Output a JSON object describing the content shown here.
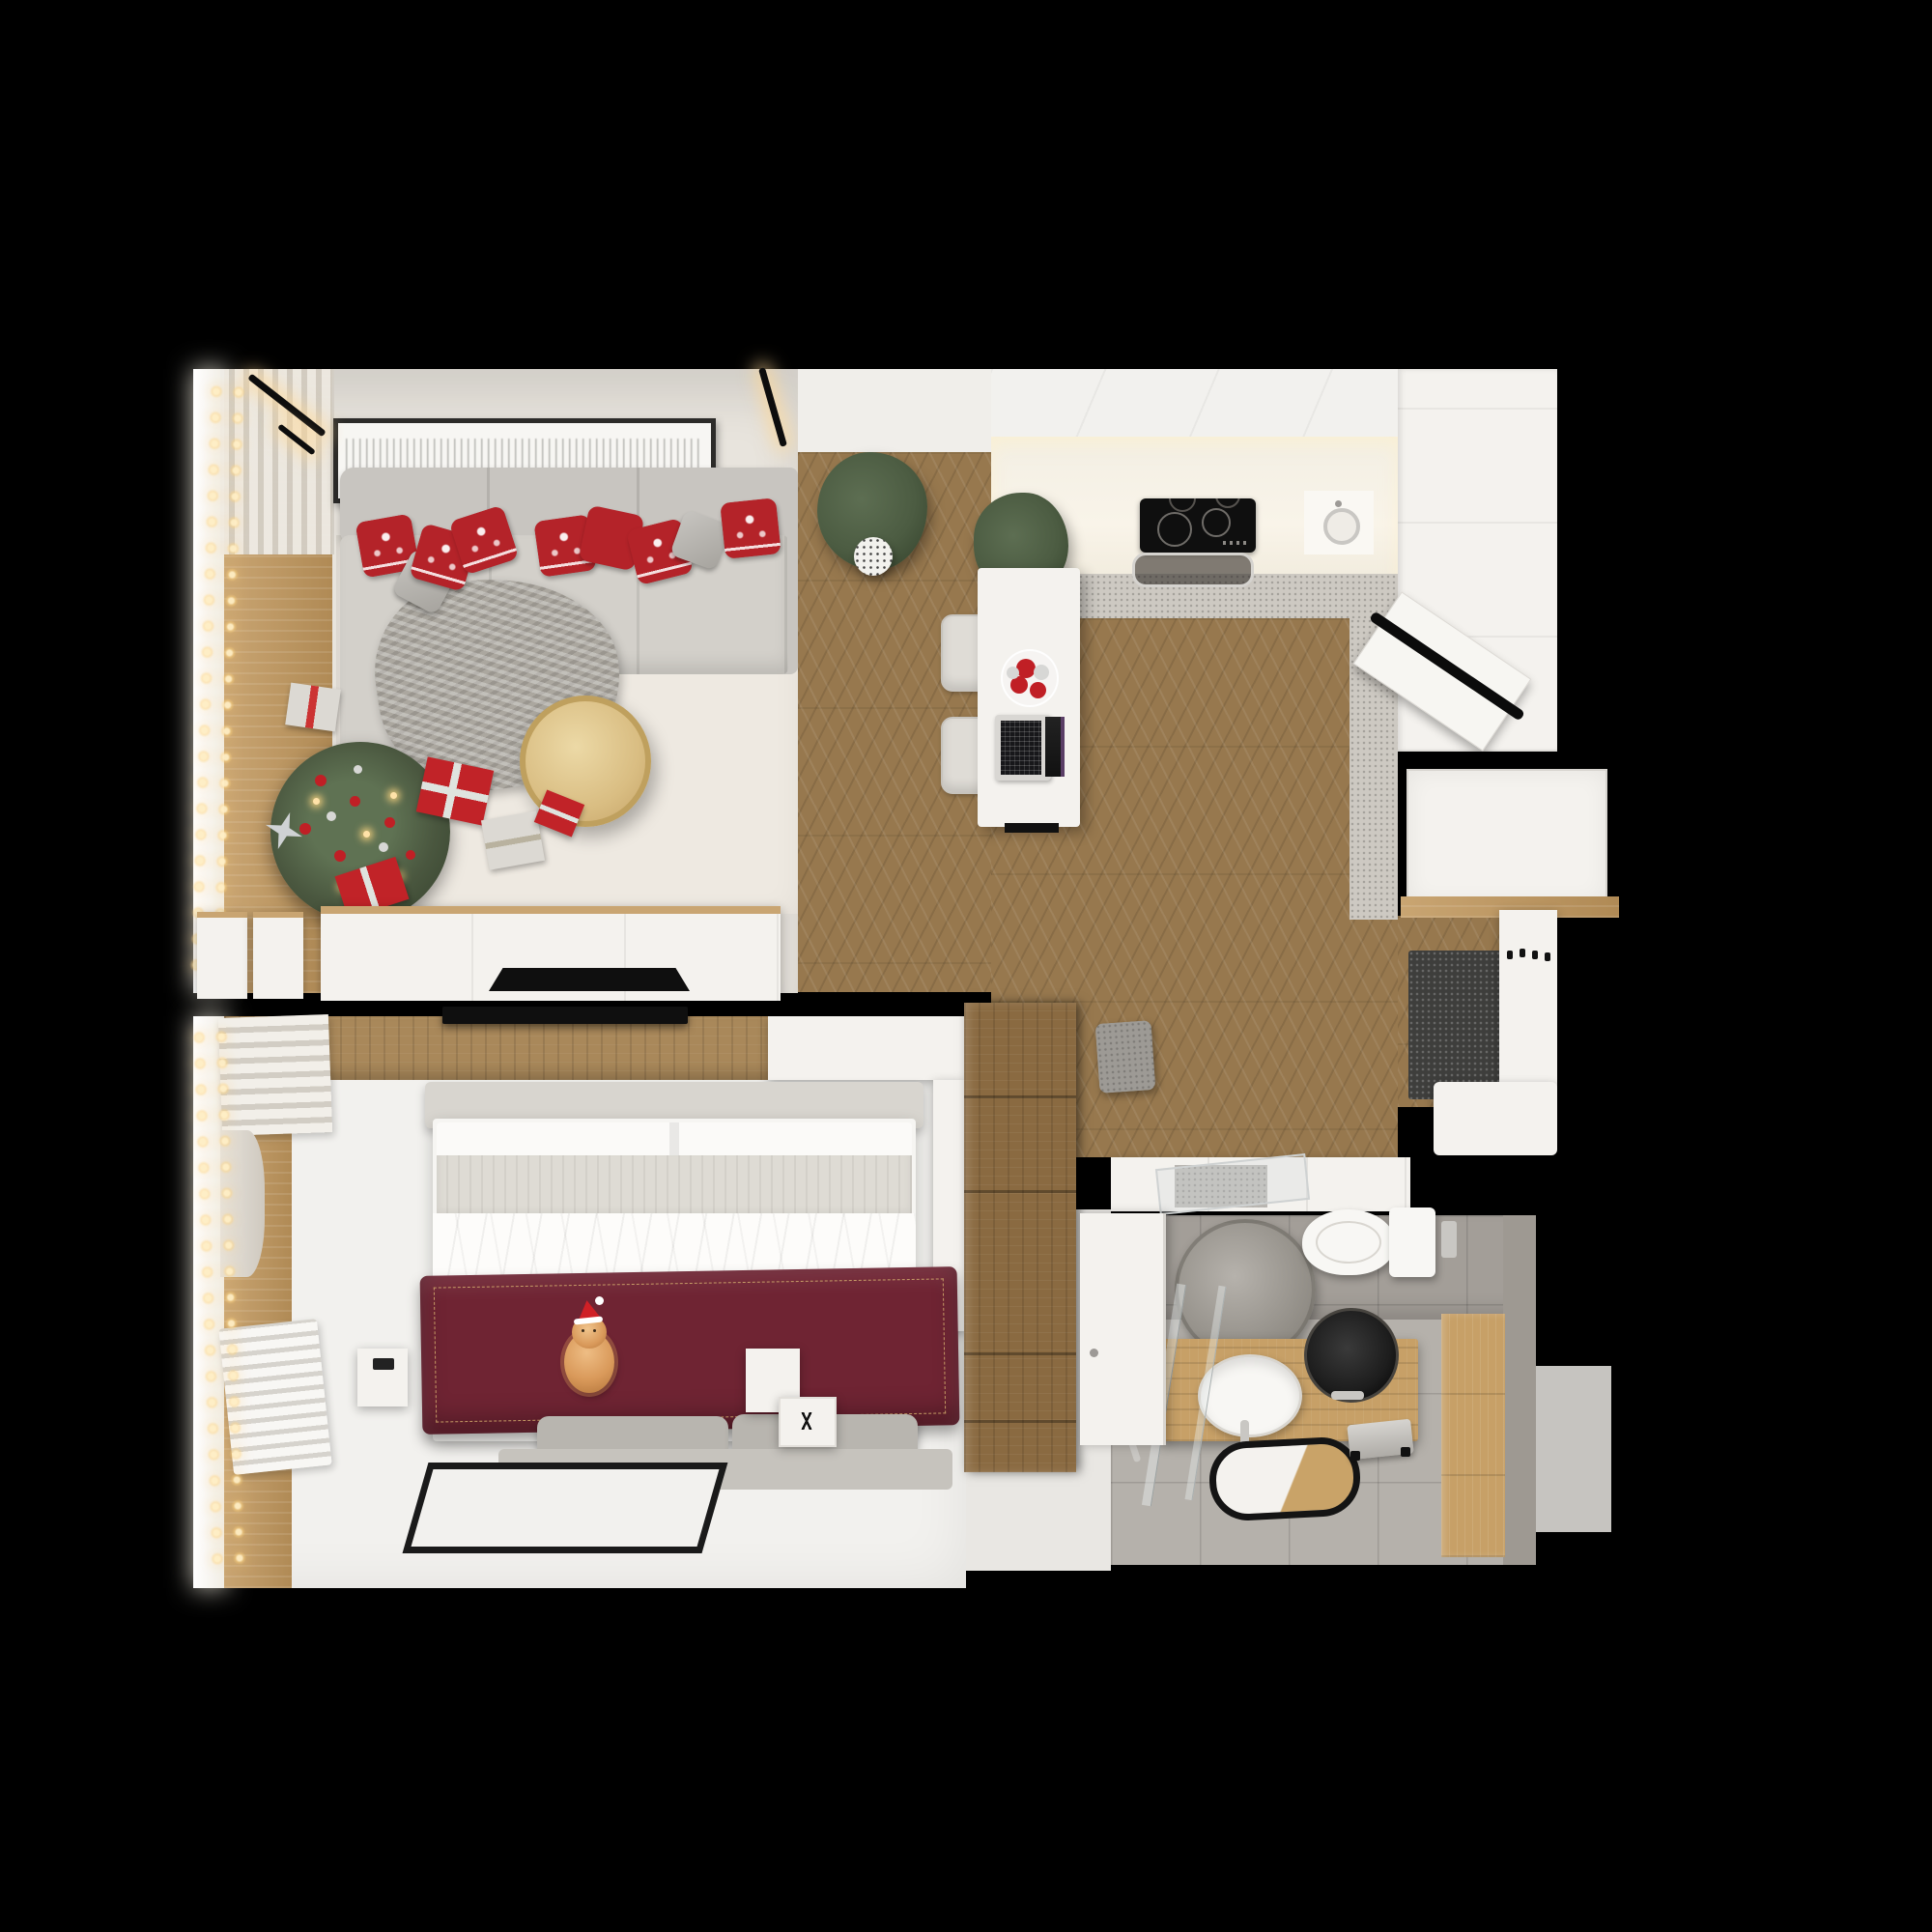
{
  "scene": {
    "title": "apartment-floor-plan-3d-render",
    "description": "Top-down photorealistic 3D render of a small one-bedroom apartment decorated for Christmas, on a black background",
    "rooms": [
      {
        "name": "living-room",
        "objects": [
          "corner-sofa",
          "nordic-red-pillows",
          "grey-pillows",
          "knit-throw",
          "gold-round-coffee-table",
          "christmas-tree-with-ornaments",
          "gift-boxes",
          "string-lights-garland",
          "framed-wall-art",
          "linear-wall-sconces",
          "tv-sideboard",
          "flat-tv",
          "window-with-curtains",
          "area-rug",
          "window-side-cabinets"
        ]
      },
      {
        "name": "kitchen-dining",
        "objects": [
          "chevron-parquet-floor",
          "white-cabinet-run",
          "tall-white-units",
          "induction-cooktop",
          "extractor-tray",
          "round-steel-sink",
          "speckled-countertop",
          "breakfast-bar",
          "two-bar-stools",
          "open-laptop",
          "plate-of-baubles",
          "two-potted-plants",
          "open-white-door-with-black-handle",
          "ceiling-spot"
        ]
      },
      {
        "name": "hallway-entry",
        "objects": [
          "open-entry-door",
          "wood-threshold",
          "dark-doormat",
          "coat-hook-panel",
          "shoe-bench",
          "tall-wooden-wardrobe",
          "grey-pouf",
          "closet-band-with-mirror-door"
        ]
      },
      {
        "name": "bedroom",
        "objects": [
          "double-bed",
          "burgundy-quilt-gold-stitch",
          "ginger-cat-in-santa-hat",
          "headboard-bench",
          "white-duvet",
          "grey-foot-cushions",
          "foot-mat",
          "black-frame-rug",
          "bedside-tables",
          "wall-mounted-tv",
          "wood-accent-band",
          "roman-shade",
          "curtain-drape",
          "radiator",
          "string-lights-garland",
          "white-console"
        ]
      },
      {
        "name": "bathroom",
        "objects": [
          "round-stone-mirror",
          "wall-hung-toilet",
          "flush-plate",
          "wooden-vanity",
          "black-vessel-sink",
          "white-oval-basin",
          "chrome-faucets",
          "shower-glass-panels",
          "shower-head",
          "black-rim-bath-mat",
          "step-stool",
          "wood-wall-panel",
          "open-white-door",
          "grey-exterior-block"
        ]
      }
    ]
  },
  "palette": {
    "bg": "#000000",
    "lr_floor": "#e8e4dd",
    "lr_rug": "#eee9e1",
    "wood_floor": "#97784e",
    "wood_light": "#c9a572",
    "wood_accent": "#a9885a",
    "wood_wardrobe": "#8a6a41",
    "white_furn": "#f4f2ee",
    "kitchen_white": "#f2f1ee",
    "kitchen_warm": "#f9f4e9",
    "counter_speckle": "#cdc9c2",
    "sofa": "#c8c5c0",
    "sofa_seat": "#d3d0ca",
    "pillow_red": "#b42329",
    "pillow_grey": "#b4b1ab",
    "throw_grey": "#aba79f",
    "table_gold": "#d9bd82",
    "table_gold_rim": "#bfa05e",
    "tree_green": "#4a573f",
    "ball_red": "#c01f25",
    "ball_silver": "#d7d7d5",
    "light_warm": "#ffe2a8",
    "gift_red": "#c12328",
    "gift_white": "#dcd9d3",
    "tv_black": "#0f0f0f",
    "blanket": "#6f2433",
    "blanket_stitch": "#d4af6e",
    "cat_orange": "#d9995a",
    "hat_red": "#cf2026",
    "bed_bench": "#d8d5cf",
    "bed_quilt": "#dedbd4",
    "bed_white": "#f6f5f2",
    "cushion_grey": "#b8b5af",
    "rug_border": "#1a1a1a",
    "bath_floor": "#b5b1ab",
    "bath_wall": "#a39e98",
    "bath_wood": "#c7a067",
    "sink_black": "#1d1d1d",
    "porcelain": "#f8f7f4",
    "mat_dark": "#3e3e3c",
    "steel": "#c9c7c3",
    "plant_green": "#4c5c42"
  }
}
